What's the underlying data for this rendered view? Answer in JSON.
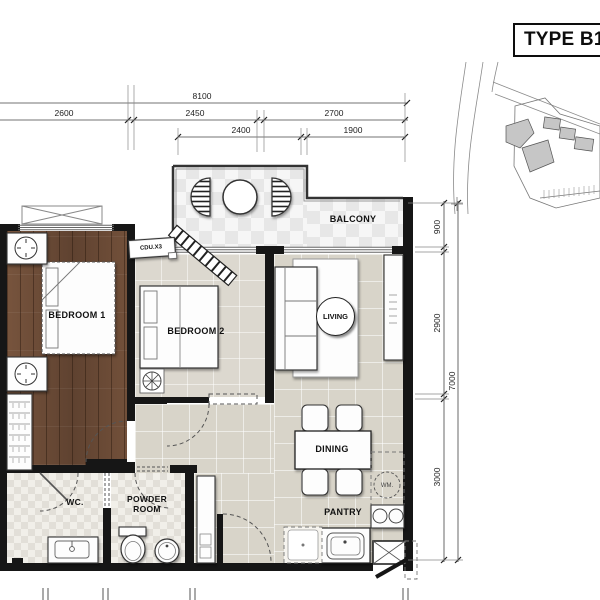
{
  "title": "TYPE B1-",
  "rooms": {
    "bedroom1": "BEDROOM 1",
    "bedroom2": "BEDROOM 2",
    "living": "LIVING",
    "balcony": "BALCONY",
    "dining": "DINING",
    "pantry": "PANTRY",
    "wc": "WC.",
    "powder_room": "POWDER ROOM"
  },
  "equipment": {
    "cdu": "CDU.X3",
    "washing_machine": "WM."
  },
  "dimensions": {
    "top": {
      "overall": "8100",
      "segments": [
        "2600",
        "2450",
        "2700"
      ],
      "sub_segments": [
        "2400",
        "1900"
      ]
    },
    "right": {
      "overall": "7000",
      "segments": [
        "900",
        "2900",
        "3000"
      ]
    }
  },
  "colors": {
    "wall": "#161616",
    "wood_floor": "#6f4d38",
    "tile_floor": "#d8d4c9",
    "balcony_tile": "#ededed",
    "background": "#ffffff"
  }
}
